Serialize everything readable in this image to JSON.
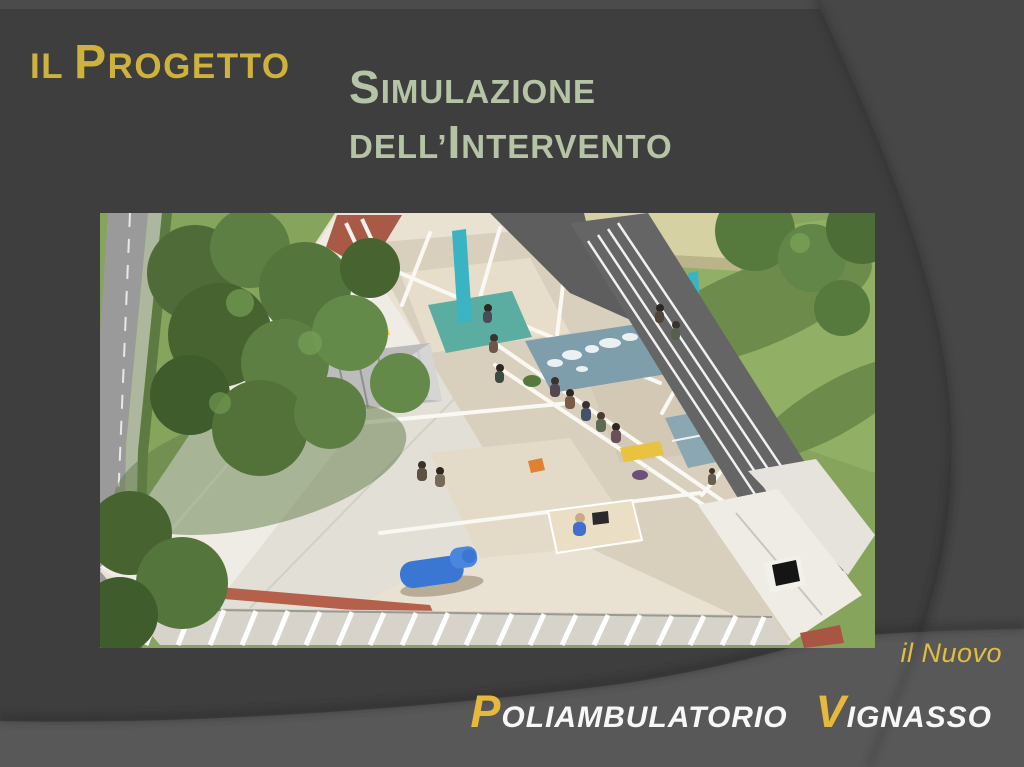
{
  "slide": {
    "title": {
      "small1": "IL",
      "big1": "P",
      "small2": "ROGETTO"
    },
    "subtitle": {
      "line1_big": "S",
      "line1_rest": "IMULAZIONE",
      "line2_small": "DELL’",
      "line2_big": "I",
      "line2_rest": "NTERVENTO"
    },
    "footer": {
      "tagline": "il Nuovo",
      "brand_initial1": "P",
      "brand_rest1": "OLIAMBULATORIO",
      "brand_initial2": "V",
      "brand_rest2": "IGNASSO"
    }
  },
  "image": {
    "description": "Aerial cutaway 3D rendering of the planned clinic: the roof is removed to reveal consultation rooms, waiting areas with seated patients, a reception desk and a blue examination chair; the building is surrounded by lawn, trees, a street on the left and an access ramp on the right next to a neighbouring yellow building.",
    "palette": {
      "grass": "#87a45d",
      "walls": "#e9e1d1",
      "floor": "#d9cfbd",
      "teal_roof": "#7e9eab",
      "accent_teal": "#3ab4c2",
      "exam_chair_blue": "#3a77d3",
      "brick": "#a85a46",
      "path_gray": "#656565"
    }
  },
  "theme": {
    "background": "#3e3e3e",
    "top_strip": "#4b4b4b",
    "right_panel": "#474747",
    "bottom_band": "#585858",
    "title_gold": "#cfb23d",
    "subtitle_sage": "#b6c4a6",
    "footer_gold": "#e6b93e",
    "footer_white": "#f7f7f7"
  }
}
